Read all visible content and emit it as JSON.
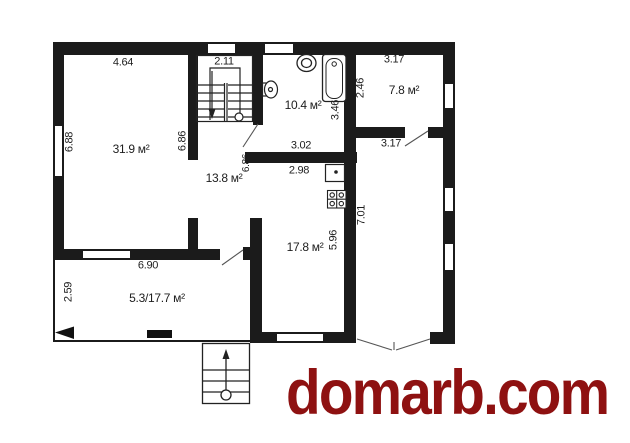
{
  "watermark": {
    "text": "domarb.com",
    "color": "#8e1111"
  },
  "plan": {
    "type": "architectural-floor-plan",
    "area_labels": [
      {
        "room": "living-room",
        "text": "31.9 м²"
      },
      {
        "room": "hall",
        "text": "13.8 м²"
      },
      {
        "room": "bathroom",
        "text": "10.4 м²"
      },
      {
        "room": "top-right-room",
        "text": "7.8 м²"
      },
      {
        "room": "kitchen-dining",
        "text": "17.8 м²"
      },
      {
        "room": "terrace",
        "text": "5.3/17.7 м²"
      }
    ],
    "dimension_labels": [
      {
        "edge": "living-top",
        "text": "4.64"
      },
      {
        "edge": "stairs-top",
        "text": "2.11"
      },
      {
        "edge": "top-right-top",
        "text": "3.17"
      },
      {
        "edge": "left-wall",
        "text": "6.88"
      },
      {
        "edge": "top-right-left",
        "text": "2.46"
      },
      {
        "edge": "bathroom-right",
        "text": "3.46"
      },
      {
        "edge": "living-right",
        "text": "6.86"
      },
      {
        "edge": "hall-right",
        "text": "6.86"
      },
      {
        "edge": "bathroom-bottom",
        "text": "3.02"
      },
      {
        "edge": "kitchen-top",
        "text": "2.98"
      },
      {
        "edge": "corridor-top",
        "text": "3.17"
      },
      {
        "edge": "corridor-right",
        "text": "7.01"
      },
      {
        "edge": "kitchen-right",
        "text": "5.96"
      },
      {
        "edge": "terrace-top",
        "text": "6.90"
      },
      {
        "edge": "terrace-left",
        "text": "2.59"
      }
    ],
    "symbols": [
      "window",
      "door-swing",
      "double-entry-door",
      "interior-staircase",
      "entrance-steps",
      "toilet",
      "washbasin",
      "bathtub",
      "kitchen-sink",
      "stove-4-burner",
      "porch-posts"
    ]
  }
}
